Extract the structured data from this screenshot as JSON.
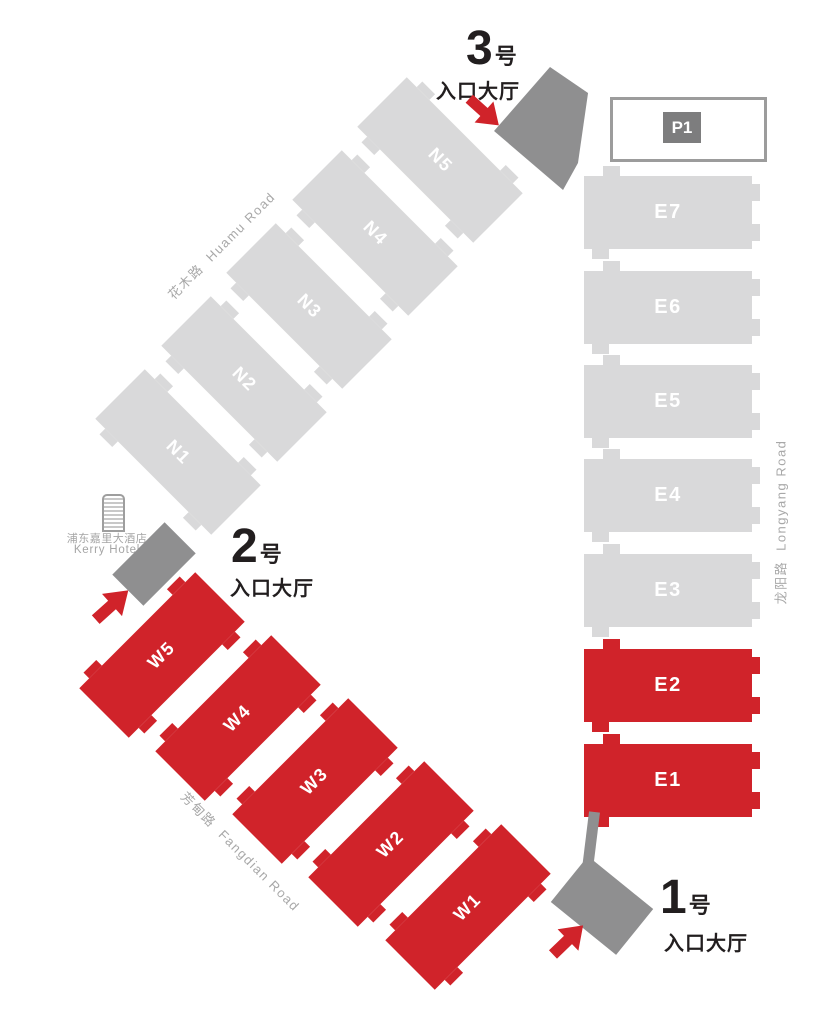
{
  "halls": {
    "north": [
      {
        "label": "N1"
      },
      {
        "label": "N2"
      },
      {
        "label": "N3"
      },
      {
        "label": "N4"
      },
      {
        "label": "N5"
      }
    ],
    "west": [
      {
        "label": "W1"
      },
      {
        "label": "W2"
      },
      {
        "label": "W3"
      },
      {
        "label": "W4"
      },
      {
        "label": "W5"
      }
    ],
    "east": [
      {
        "label": "E1"
      },
      {
        "label": "E2"
      },
      {
        "label": "E3"
      },
      {
        "label": "E4"
      },
      {
        "label": "E5"
      },
      {
        "label": "E6"
      },
      {
        "label": "E7"
      }
    ]
  },
  "entrances": [
    {
      "number": "1",
      "unit": "号",
      "hall_label": "入口大厅"
    },
    {
      "number": "2",
      "unit": "号",
      "hall_label": "入口大厅"
    },
    {
      "number": "3",
      "unit": "号",
      "hall_label": "入口大厅"
    }
  ],
  "parking": {
    "label": "P1"
  },
  "hotel": {
    "name_cn": "浦东嘉里大酒店",
    "name_en": "Kerry Hotel"
  },
  "roads": {
    "huamu": {
      "cn": "花木路",
      "en": "Huamu Road"
    },
    "longyang": {
      "cn": "龙阳路",
      "en": "Longyang Road"
    },
    "fangdian": {
      "cn": "芳甸路",
      "en": "Fangdian Road"
    }
  },
  "colors": {
    "hall_red": "#d0232a",
    "hall_gray": "#d9d9da",
    "structure_gray": "#8f8f90",
    "parking_badge_gray": "#7d7d7e",
    "parking_border_gray": "#9c9c9c",
    "road_text_gray": "#a8a8a8",
    "text_black": "#221e1f",
    "hall_label_white": "#ffffff"
  }
}
